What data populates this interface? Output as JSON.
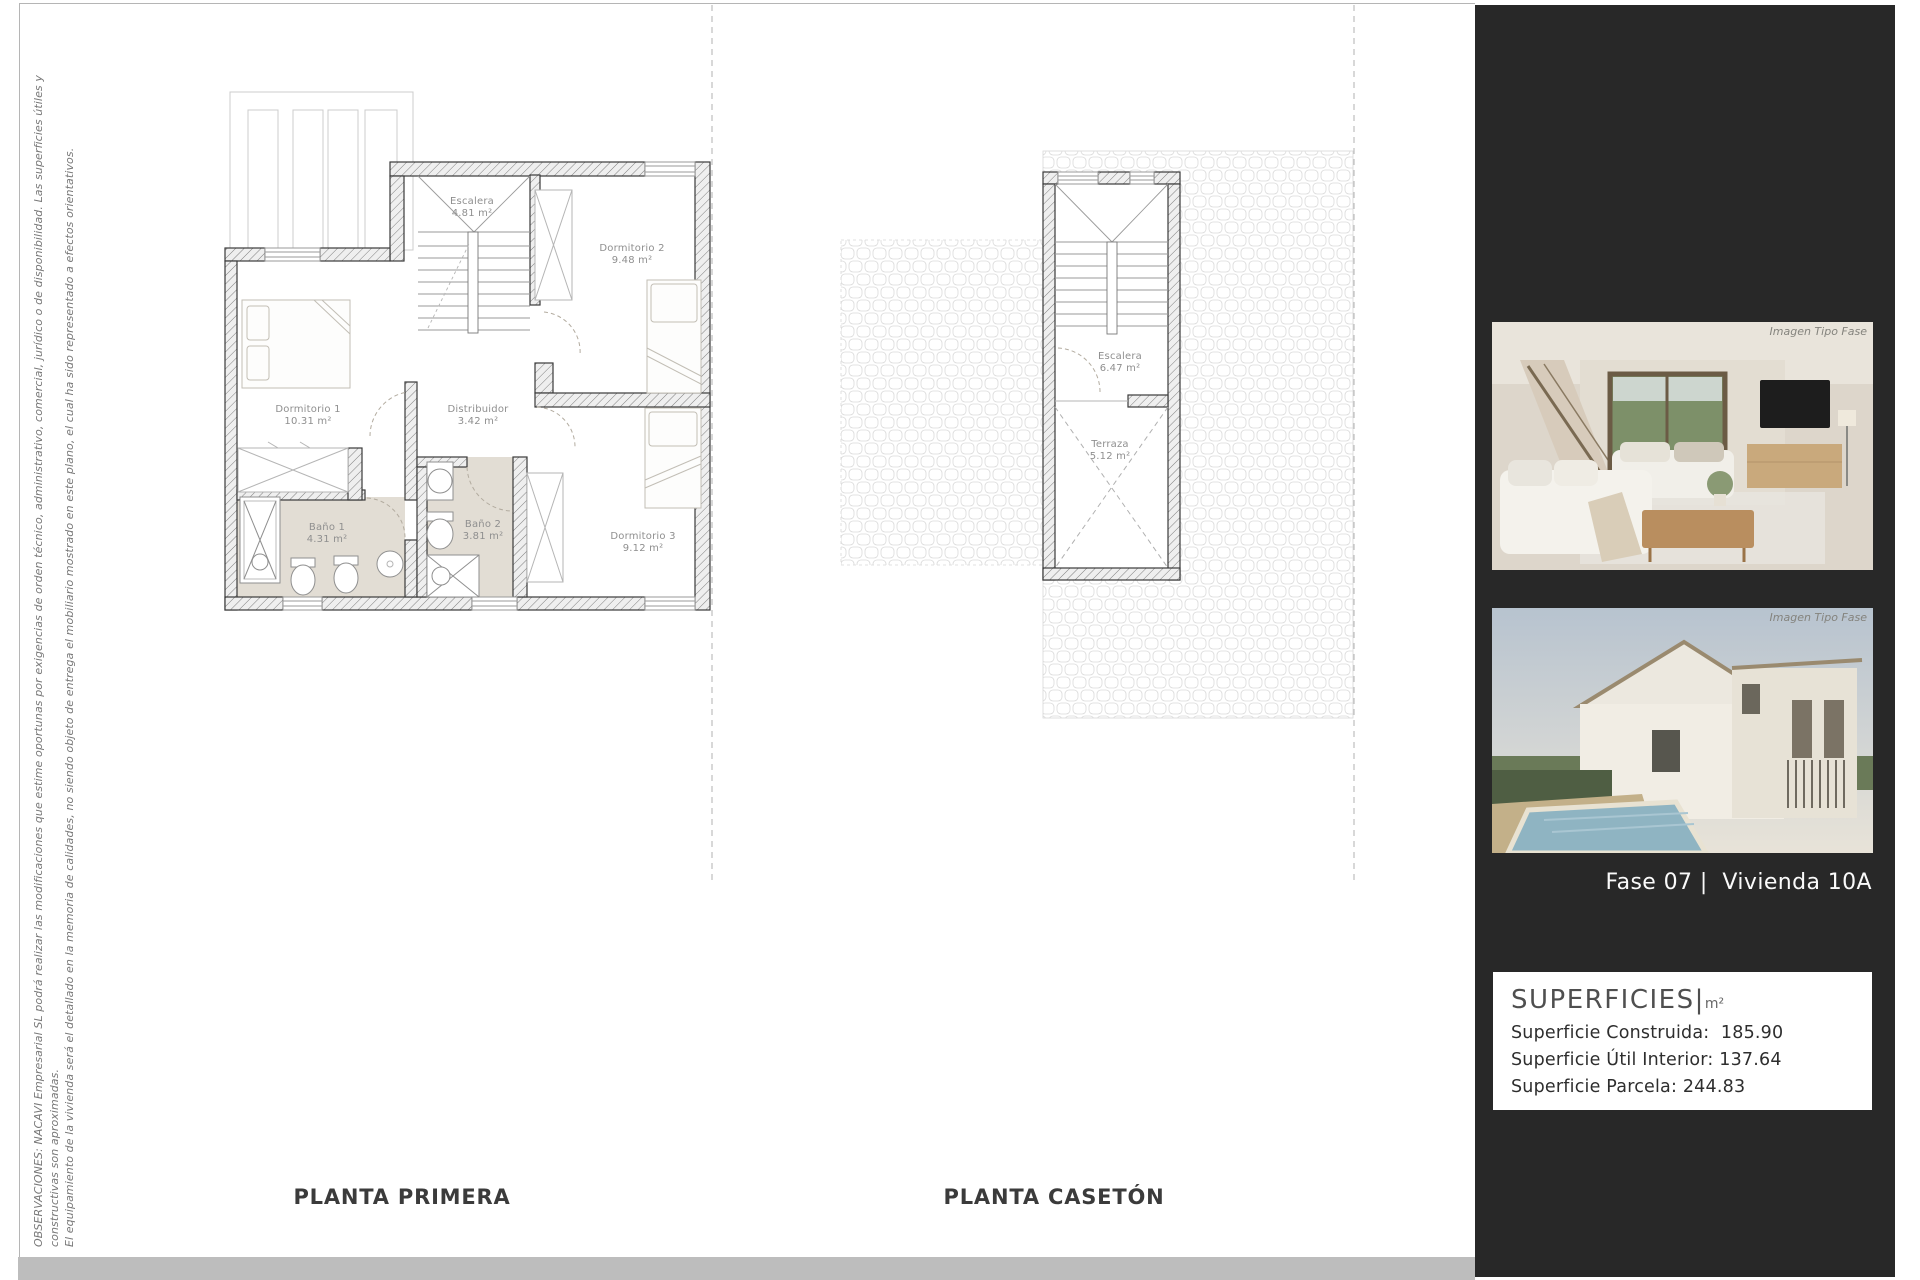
{
  "document": {
    "disclaimer": {
      "line1": "OBSERVACIONES: NACAVI Empresarial SL podrá realizar las modificaciones que estime oportunas por exigencias de orden técnico, administrativo, comercial, jurídico o de disponibilidad. Las superficies útiles y constructivas son aproximadas.",
      "line2": "El equipamiento de la vivienda será el detallado en la memoria de calidades, no siendo objeto de entrega el mobiliario mostrado en este plano, el  cual ha sido representado a efectos orientativos."
    }
  },
  "plans": [
    {
      "title": "PLANTA PRIMERA",
      "rooms": [
        {
          "name": "Escalera",
          "area": "4.81 m²"
        },
        {
          "name": "Dormitorio 2",
          "area": "9.48 m²"
        },
        {
          "name": "Dormitorio 1",
          "area": "10.31 m²"
        },
        {
          "name": "Distribuidor",
          "area": "3.42 m²"
        },
        {
          "name": "Baño 1",
          "area": "4.31 m²"
        },
        {
          "name": "Baño 2",
          "area": "3.81 m²"
        },
        {
          "name": "Dormitorio 3",
          "area": "9.12 m²"
        }
      ]
    },
    {
      "title": "PLANTA CASETÓN",
      "rooms": [
        {
          "name": "Escalera",
          "area": "6.47 m²"
        },
        {
          "name": "Terraza",
          "area": "5.12 m²"
        }
      ]
    }
  ],
  "sidebar": {
    "photo_watermark": "Imagen Tipo Fase",
    "unit_label": "Fase 07 |  Vivienda 10A",
    "superficies": {
      "title": "SUPERFICIES|",
      "unit": "m²",
      "rows": [
        "Superficie Construida:  185.90",
        "Superficie Útil Interior: 137.64",
        "Superficie Parcela: 244.83"
      ]
    }
  },
  "colors": {
    "sidebar_bg": "#282828",
    "bottom_band": "#bdbdbd",
    "bath_floor": "#e2ddd4",
    "page_border": "#b5b5b5"
  }
}
